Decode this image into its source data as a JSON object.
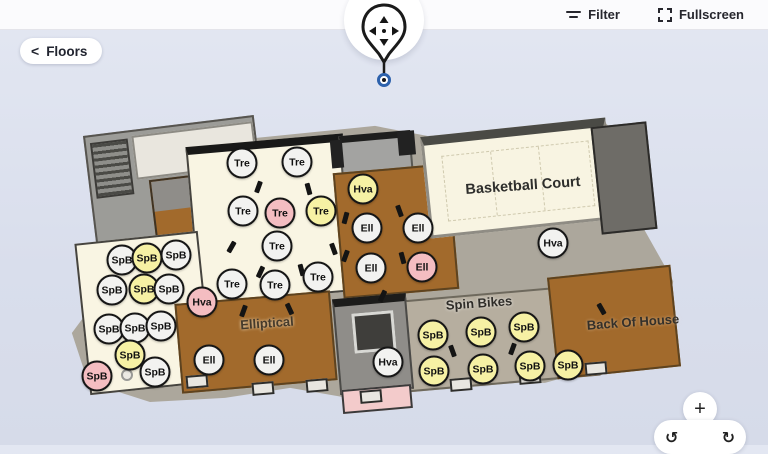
{
  "header": {
    "filter_label": "Filter",
    "fullscreen_label": "Fullscreen"
  },
  "floors": {
    "chevron": "<",
    "label": "Floors"
  },
  "map": {
    "zone_labels": {
      "basketball": "Basketball Court",
      "spin_bikes": "Spin Bikes",
      "elliptical": "Elliptical",
      "back_of_house": "Back Of House"
    },
    "marker_colors": {
      "white": "#f2f2f0",
      "yellow": "#f6f1a4",
      "pink": "#f4bdc1"
    },
    "markers": [
      {
        "label": "Tre",
        "variant": "white",
        "x": 242,
        "y": 163
      },
      {
        "label": "Tre",
        "variant": "white",
        "x": 297,
        "y": 162
      },
      {
        "label": "Tre",
        "variant": "white",
        "x": 243,
        "y": 211
      },
      {
        "label": "Tre",
        "variant": "pink",
        "x": 280,
        "y": 213
      },
      {
        "label": "Tre",
        "variant": "yellow",
        "x": 321,
        "y": 211
      },
      {
        "label": "Tre",
        "variant": "white",
        "x": 277,
        "y": 246
      },
      {
        "label": "Tre",
        "variant": "white",
        "x": 232,
        "y": 284
      },
      {
        "label": "Tre",
        "variant": "white",
        "x": 275,
        "y": 285
      },
      {
        "label": "Tre",
        "variant": "white",
        "x": 318,
        "y": 277
      },
      {
        "label": "Hva",
        "variant": "yellow",
        "x": 363,
        "y": 189
      },
      {
        "label": "Hva",
        "variant": "white",
        "x": 553,
        "y": 243
      },
      {
        "label": "Hva",
        "variant": "pink",
        "x": 202,
        "y": 302
      },
      {
        "label": "Hva",
        "variant": "white",
        "x": 388,
        "y": 362
      },
      {
        "label": "Ell",
        "variant": "white",
        "x": 367,
        "y": 228
      },
      {
        "label": "Ell",
        "variant": "white",
        "x": 418,
        "y": 228
      },
      {
        "label": "Ell",
        "variant": "white",
        "x": 371,
        "y": 268
      },
      {
        "label": "Ell",
        "variant": "pink",
        "x": 422,
        "y": 267
      },
      {
        "label": "Ell",
        "variant": "white",
        "x": 209,
        "y": 360
      },
      {
        "label": "Ell",
        "variant": "white",
        "x": 269,
        "y": 360
      },
      {
        "label": "SpB",
        "variant": "white",
        "x": 122,
        "y": 260
      },
      {
        "label": "SpB",
        "variant": "yellow",
        "x": 147,
        "y": 258
      },
      {
        "label": "SpB",
        "variant": "white",
        "x": 176,
        "y": 255
      },
      {
        "label": "SpB",
        "variant": "white",
        "x": 112,
        "y": 290
      },
      {
        "label": "SpB",
        "variant": "yellow",
        "x": 144,
        "y": 289
      },
      {
        "label": "SpB",
        "variant": "white",
        "x": 169,
        "y": 289
      },
      {
        "label": "SpB",
        "variant": "white",
        "x": 109,
        "y": 329
      },
      {
        "label": "SpB",
        "variant": "white",
        "x": 135,
        "y": 328
      },
      {
        "label": "SpB",
        "variant": "white",
        "x": 161,
        "y": 326
      },
      {
        "label": "SpB",
        "variant": "yellow",
        "x": 130,
        "y": 355
      },
      {
        "label": "SpB",
        "variant": "pink",
        "x": 97,
        "y": 376
      },
      {
        "label": "SpB",
        "variant": "white",
        "x": 155,
        "y": 372
      },
      {
        "label": "SpB",
        "variant": "yellow",
        "x": 433,
        "y": 335
      },
      {
        "label": "SpB",
        "variant": "yellow",
        "x": 481,
        "y": 332
      },
      {
        "label": "SpB",
        "variant": "yellow",
        "x": 524,
        "y": 327
      },
      {
        "label": "SpB",
        "variant": "yellow",
        "x": 434,
        "y": 371
      },
      {
        "label": "SpB",
        "variant": "yellow",
        "x": 483,
        "y": 369
      },
      {
        "label": "SpB",
        "variant": "yellow",
        "x": 530,
        "y": 366
      },
      {
        "label": "SpB",
        "variant": "yellow",
        "x": 568,
        "y": 365
      }
    ]
  },
  "controls": {
    "zoom_in": "+",
    "rotate_ccw": "↺",
    "rotate_cw": "↻"
  }
}
